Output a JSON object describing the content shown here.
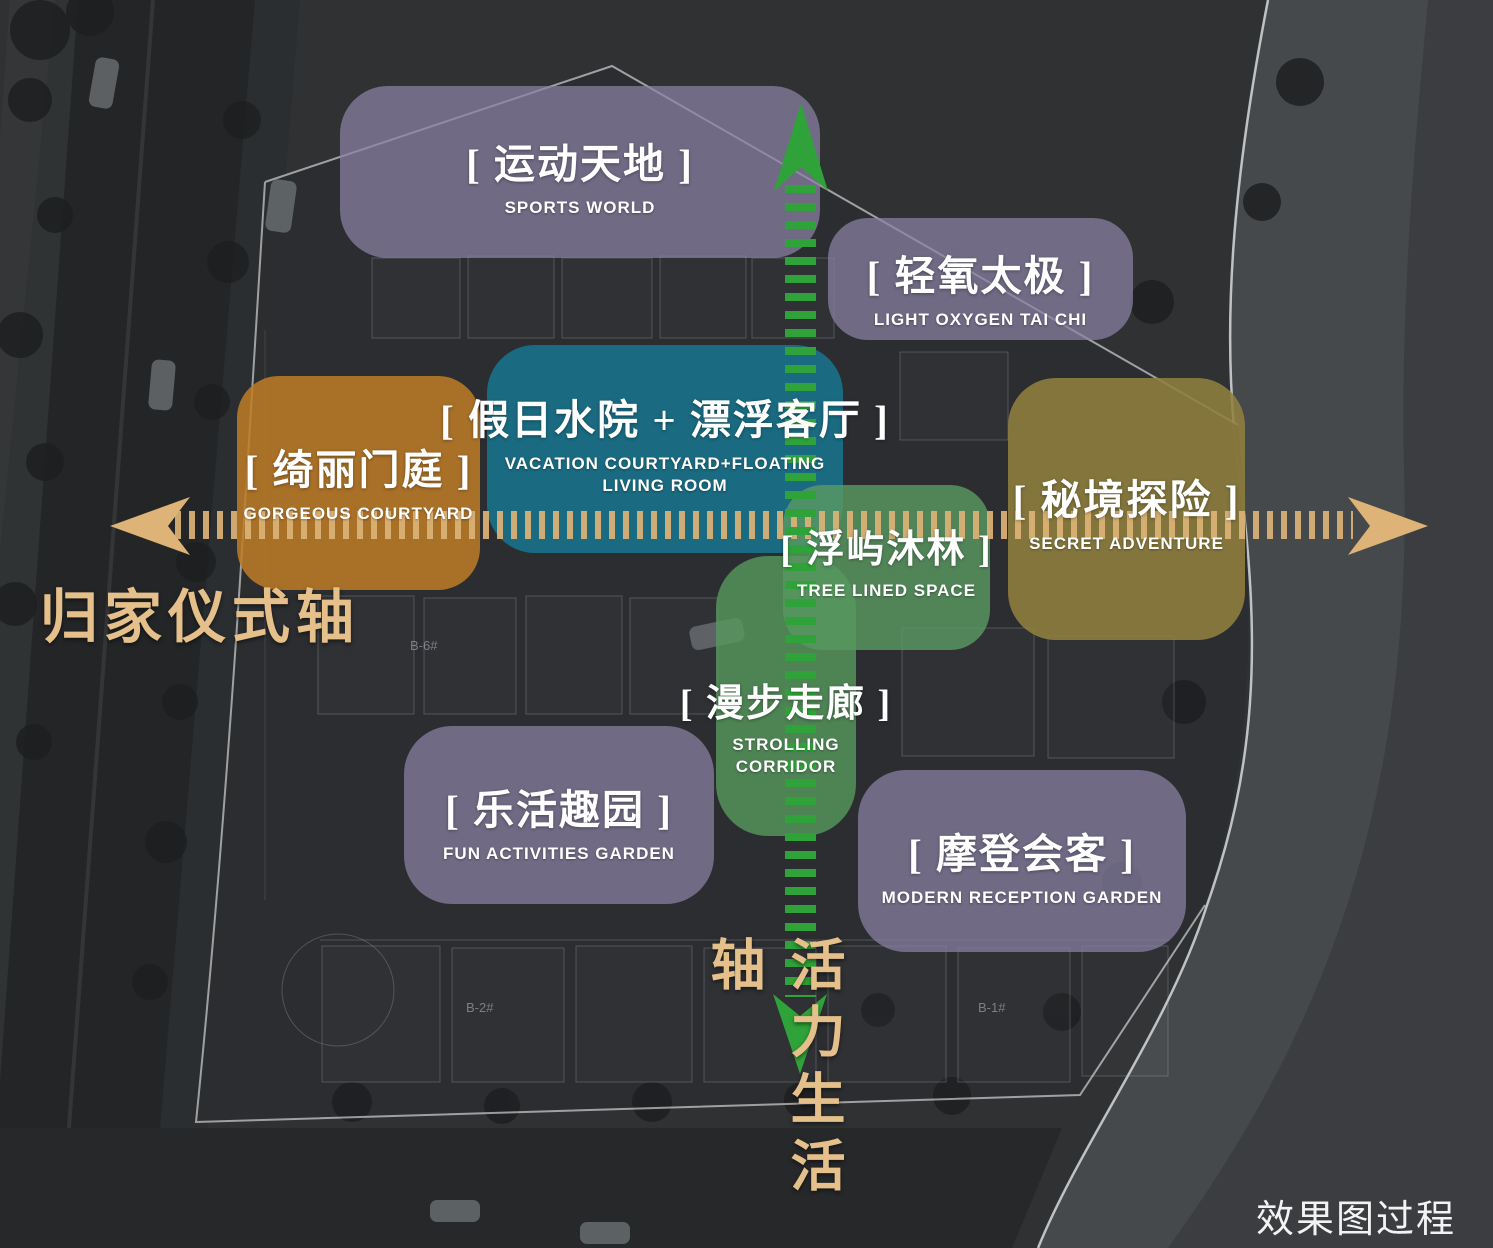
{
  "watermark": "效果图过程稿",
  "axes": {
    "horizontal": {
      "label": "归家仪式轴",
      "label_color": "#e5c08a",
      "dash_color": "#ddb377"
    },
    "vertical": {
      "label": "活力生活轴",
      "label_color": "#e5c08a",
      "dash_color": "#2fa339"
    }
  },
  "zones": [
    {
      "id": "sports-world",
      "zh": "[ 运动天地 ]",
      "en": "SPORTS WORLD",
      "fill": "#8b82a5"
    },
    {
      "id": "light-oxygen-tai-chi",
      "zh": "[ 轻氧太极 ]",
      "en": "LIGHT OXYGEN TAI CHI",
      "fill": "#8b82a5"
    },
    {
      "id": "vacation-floating",
      "zh": "[ 假日水院 + 漂浮客厅 ]",
      "en": "VACATION COURTYARD+FLOATING\nLIVING ROOM",
      "fill": "#17768f"
    },
    {
      "id": "gorgeous-courtyard",
      "zh": "[ 绮丽门庭 ]",
      "en": "GORGEOUS COURTYARD",
      "fill": "#bf7d26"
    },
    {
      "id": "secret-adventure",
      "zh": "[ 秘境探险 ]",
      "en": "SECRET ADVENTURE",
      "fill": "#8f7f3e"
    },
    {
      "id": "tree-lined-space",
      "zh": "[ 浮屿沐林 ]",
      "en": "TREE LINED SPACE",
      "fill": "#5b9b63"
    },
    {
      "id": "strolling-corridor",
      "zh": "[ 漫步走廊 ]",
      "en": "STROLLING CORRIDOR",
      "fill": "#57995e"
    },
    {
      "id": "fun-activities-garden",
      "zh": "[ 乐活趣园 ]",
      "en": "FUN ACTIVITIES GARDEN",
      "fill": "#8b82a5"
    },
    {
      "id": "modern-reception-garden",
      "zh": "[ 摩登会客 ]",
      "en": "MODERN RECEPTION GARDEN",
      "fill": "#8b82a5"
    }
  ],
  "background": {
    "building_labels": [
      "B-2#",
      "B-6#",
      "B-1#"
    ]
  }
}
